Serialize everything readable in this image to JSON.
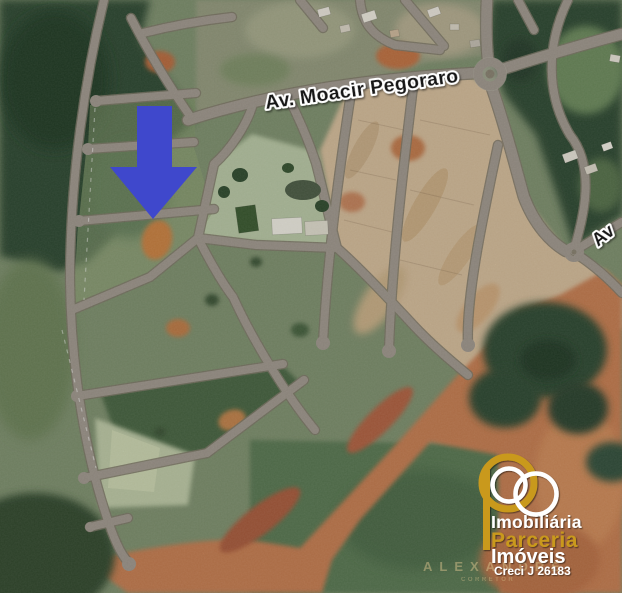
{
  "image": {
    "kind": "satellite-map-listing-image",
    "width_px": 622,
    "height_px": 593
  },
  "map": {
    "street_label_main": "Av. Moacir Pegoraro",
    "street_label_partial": "Av",
    "marker": {
      "shape": "down-arrow",
      "color": "#3f48cc"
    },
    "features": {
      "roundabout_count": 2,
      "terrain": [
        "forest",
        "green fields",
        "subdivided tan lots",
        "orange dirt",
        "club block with buildings"
      ]
    }
  },
  "logo": {
    "line1": "Imobiliária",
    "brand": "Parceria",
    "line3": "Imóveis",
    "creci": "Creci J 26183",
    "gold": "#c9991f",
    "white": "#ffffff",
    "monogram": "P made of gold and white rings"
  },
  "watermark": {
    "name": "ALEXANDRE",
    "subtitle": "CORRETOR",
    "color": "#d8c28c"
  }
}
